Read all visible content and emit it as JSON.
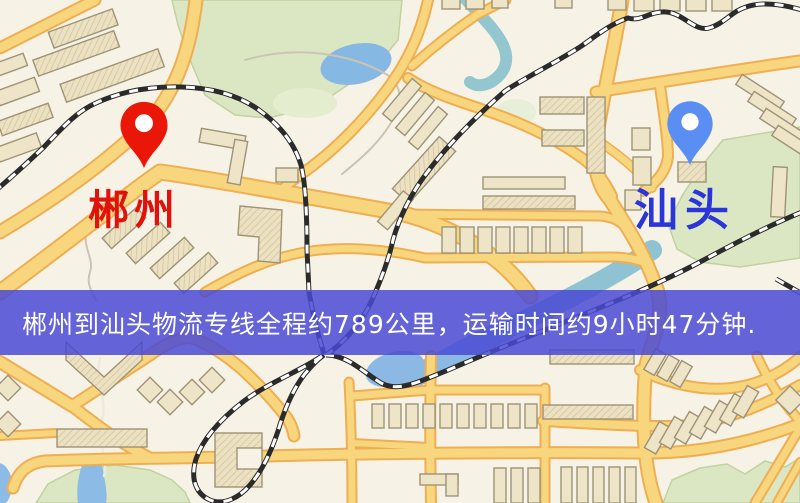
{
  "map": {
    "origin": {
      "name": "郴州",
      "pin_color": "#ea1708",
      "label_color": "#e01209"
    },
    "destination": {
      "name": "汕头",
      "pin_color": "#5b8ef2",
      "label_color": "#2a36d8"
    }
  },
  "banner": {
    "text": "郴州到汕头物流专线全程约789公里，运输时间约9小时47分钟.",
    "background_color": "#4a4ad3",
    "text_color": "#ffffff",
    "distance_km": "789",
    "duration": "9小时47分钟"
  },
  "icons": {
    "origin_pin": "map-pin",
    "destination_pin": "map-pin"
  }
}
